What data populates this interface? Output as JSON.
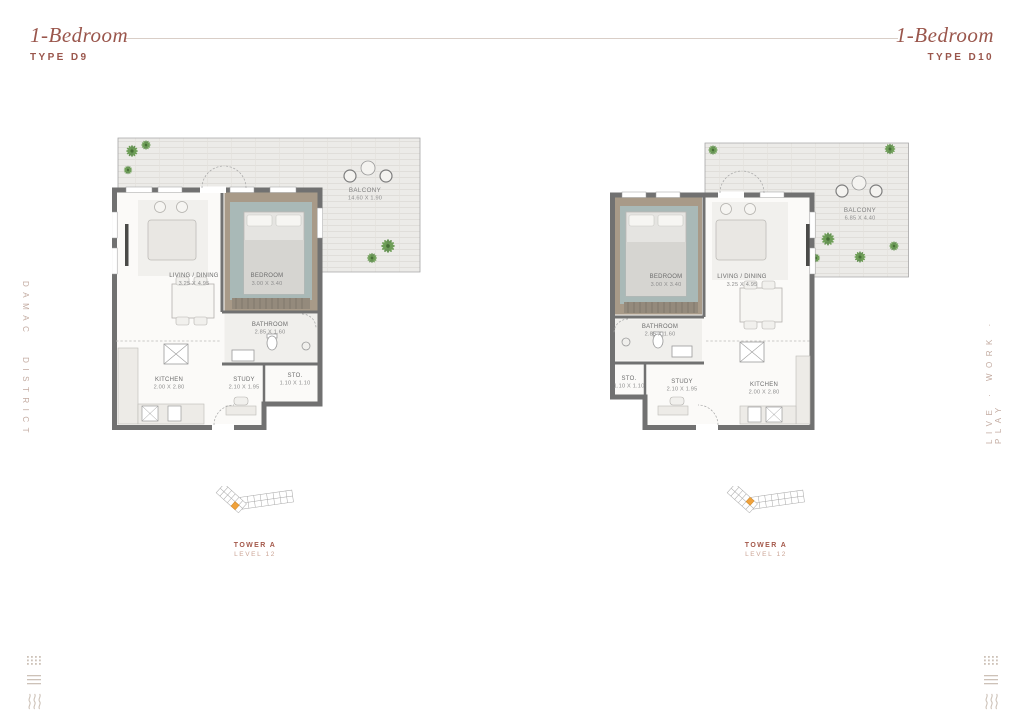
{
  "header": {
    "left": {
      "title": "1-Bedroom",
      "subtitle": "TYPE D9"
    },
    "right": {
      "title": "1-Bedroom",
      "subtitle": "TYPE D10"
    }
  },
  "side_text": {
    "left": "DAMAC DISTRICT",
    "right": "LIVE · WORK · PLAY"
  },
  "plans": {
    "d9": {
      "rooms": {
        "living": {
          "label": "LIVING / DINING",
          "dims": "3.25 X 4.95"
        },
        "bedroom": {
          "label": "BEDROOM",
          "dims": "3.00 X 3.40"
        },
        "bathroom": {
          "label": "BATHROOM",
          "dims": "2.85 X 1.60"
        },
        "kitchen": {
          "label": "KITCHEN",
          "dims": "2.00 X 2.80"
        },
        "study": {
          "label": "STUDY",
          "dims": "2.10 X 1.95"
        },
        "storage": {
          "label": "STO.",
          "dims": "1.10 X 1.10"
        },
        "balcony": {
          "label": "BALCONY",
          "dims": "14.60 X 1.90"
        }
      },
      "locator": {
        "tower": "TOWER A",
        "level": "LEVEL 12"
      }
    },
    "d10": {
      "rooms": {
        "living": {
          "label": "LIVING / DINING",
          "dims": "3.25 X 4.95"
        },
        "bedroom": {
          "label": "BEDROOM",
          "dims": "3.00 X 3.40"
        },
        "bathroom": {
          "label": "BATHROOM",
          "dims": "2.85 X 1.60"
        },
        "kitchen": {
          "label": "KITCHEN",
          "dims": "2.00 X 2.80"
        },
        "study": {
          "label": "STUDY",
          "dims": "2.10 X 1.95"
        },
        "storage": {
          "label": "STO.",
          "dims": "1.10 X 1.10"
        },
        "balcony": {
          "label": "BALCONY",
          "dims": "6.85 X 4.40"
        }
      },
      "locator": {
        "tower": "TOWER A",
        "level": "LEVEL 12"
      }
    }
  },
  "colors": {
    "accent": "#9a564c",
    "wall": "#717171",
    "deck": "#ecebe8",
    "bedroom_floor": "#a89a88",
    "bedroom_rug": "#a9bec0",
    "plant": "#6f9f58",
    "highlight_unit": "#f0a23c"
  }
}
